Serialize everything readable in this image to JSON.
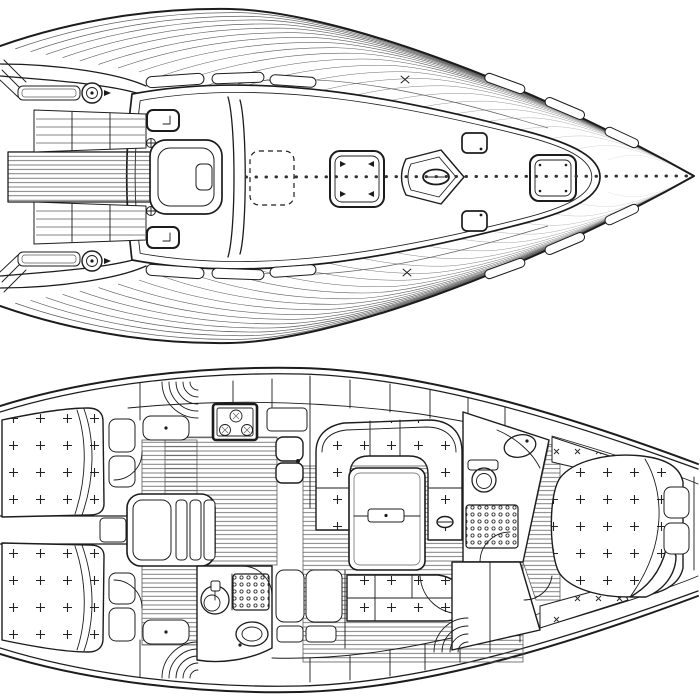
{
  "sheet": {
    "background": "#ffffff",
    "ink": "#1c1c1c",
    "light_ink": "#5f5f5f",
    "description": "Sailing yacht technical drawing: deck plan (top) and interior accommodation plan (bottom), bow pointing right"
  },
  "deck_plan": {
    "name": "deck-plan",
    "bow_direction": "right",
    "features": [
      "hull-outline",
      "teak-deck-planking",
      "stern-quarter-hatching",
      "cockpit-coamings",
      "port-coaming-slot",
      "starboard-coaming-slot",
      "port-winch",
      "starboard-winch",
      "port-bench-slats",
      "starboard-bench-slats",
      "port-cockpit-locker-hatch",
      "starboard-cockpit-locker-hatch",
      "cockpit-footwell",
      "helm-recess",
      "pedestal-fittings",
      "coachroof",
      "sea-hood",
      "companionway-sliding-hatch",
      "coachroof-handrails",
      "sheer-grab-rails",
      "skylight-hatch",
      "mast-step-plate",
      "mast-section",
      "vent-hatch-port",
      "vent-hatch-starboard",
      "fore-hatch",
      "deck-cleats",
      "dotted-centerline"
    ]
  },
  "interior_plan": {
    "name": "interior-plan",
    "bow_direction": "right",
    "features": [
      "hull-double-outline",
      "port-aft-cabin-berth",
      "port-aft-cabin-pillows",
      "port-aft-cabin-seat",
      "port-hanging-locker",
      "starboard-aft-cabin-berth",
      "starboard-aft-cabin-pillows",
      "starboard-aft-cabin-seat",
      "starboard-hanging-locker",
      "engine-compartment",
      "companionway-steps",
      "galley-floor",
      "stove-with-burners",
      "icebox-worktop",
      "double-sink",
      "overhead-locker-bands",
      "saloon-floor",
      "u-shaped-dinette",
      "saloon-table",
      "table-leaf-handle",
      "mast-post",
      "starboard-settee",
      "aft-head-washbasin",
      "aft-head-shower-grate",
      "aft-head-toilet",
      "wet-lockers",
      "forward-head",
      "forward-head-washbasin",
      "forward-head-toilet",
      "forward-head-shower-grate",
      "forward-wardrobe",
      "passageway-floor",
      "v-berth",
      "v-berth-fold-back",
      "v-berth-pillows",
      "bow-shelves"
    ]
  }
}
